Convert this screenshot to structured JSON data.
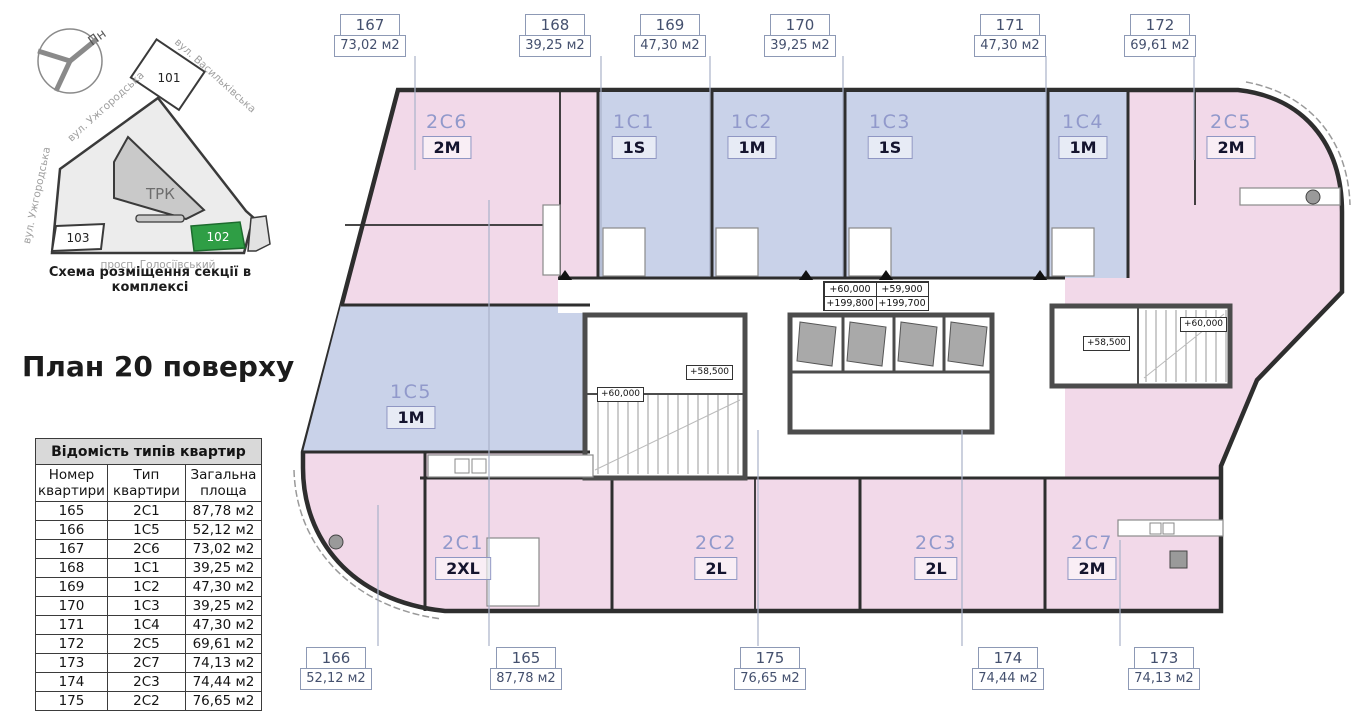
{
  "site_scheme": {
    "caption": "Схема розміщення секції в комплексі",
    "compass_label": "Пн",
    "streets": [
      "вул. Васильківська",
      "вул. Ужгородська",
      "вул. Ужгородська",
      "просп. Голосіївський"
    ],
    "buildings": {
      "b101": "101",
      "trk": "ТРК",
      "b103": "103",
      "b102": "102"
    },
    "highlight_color": "#2f9e45"
  },
  "title": "План 20 поверху",
  "table": {
    "title": "Відомість типів квартир",
    "columns": [
      "Номер квартири",
      "Тип квартири",
      "Загальна площа"
    ],
    "rows": [
      [
        "165",
        "2C1",
        "87,78 м2"
      ],
      [
        "166",
        "1C5",
        "52,12 м2"
      ],
      [
        "167",
        "2C6",
        "73,02 м2"
      ],
      [
        "168",
        "1C1",
        "39,25 м2"
      ],
      [
        "169",
        "1C2",
        "47,30 м2"
      ],
      [
        "170",
        "1C3",
        "39,25 м2"
      ],
      [
        "171",
        "1C4",
        "47,30 м2"
      ],
      [
        "172",
        "2C5",
        "69,61 м2"
      ],
      [
        "173",
        "2C7",
        "74,13 м2"
      ],
      [
        "174",
        "2C3",
        "74,44 м2"
      ],
      [
        "175",
        "2C2",
        "76,65 м2"
      ]
    ]
  },
  "plan": {
    "colors": {
      "pink": "#f2d9e9",
      "blue": "#c9d2e9",
      "label_code": "#9199cb",
      "callout_border": "#8d99b5",
      "highlight_green": "#2f9e45"
    },
    "callouts_top": [
      {
        "number": "167",
        "area": "73,02 м2"
      },
      {
        "number": "168",
        "area": "39,25 м2"
      },
      {
        "number": "169",
        "area": "47,30 м2"
      },
      {
        "number": "170",
        "area": "39,25 м2"
      },
      {
        "number": "171",
        "area": "47,30 м2"
      },
      {
        "number": "172",
        "area": "69,61 м2"
      }
    ],
    "callouts_bottom": [
      {
        "number": "166",
        "area": "52,12 м2"
      },
      {
        "number": "165",
        "area": "87,78 м2"
      },
      {
        "number": "175",
        "area": "76,65 м2"
      },
      {
        "number": "174",
        "area": "74,44 м2"
      },
      {
        "number": "173",
        "area": "74,13 м2"
      }
    ],
    "apartments": [
      {
        "code": "2C6",
        "type": "2M"
      },
      {
        "code": "1C1",
        "type": "1S"
      },
      {
        "code": "1C2",
        "type": "1M"
      },
      {
        "code": "1C3",
        "type": "1S"
      },
      {
        "code": "1C4",
        "type": "1M"
      },
      {
        "code": "2C5",
        "type": "2M"
      },
      {
        "code": "1C5",
        "type": "1M"
      },
      {
        "code": "2C1",
        "type": "2XL"
      },
      {
        "code": "2C2",
        "type": "2L"
      },
      {
        "code": "2C3",
        "type": "2L"
      },
      {
        "code": "2C7",
        "type": "2M"
      }
    ],
    "elevations": {
      "center_table": [
        "+60,000",
        "+59,900",
        "+199,800",
        "+199,700"
      ],
      "marks": [
        "+58,500",
        "+60,000",
        "+60,000",
        "+58,500"
      ]
    }
  }
}
